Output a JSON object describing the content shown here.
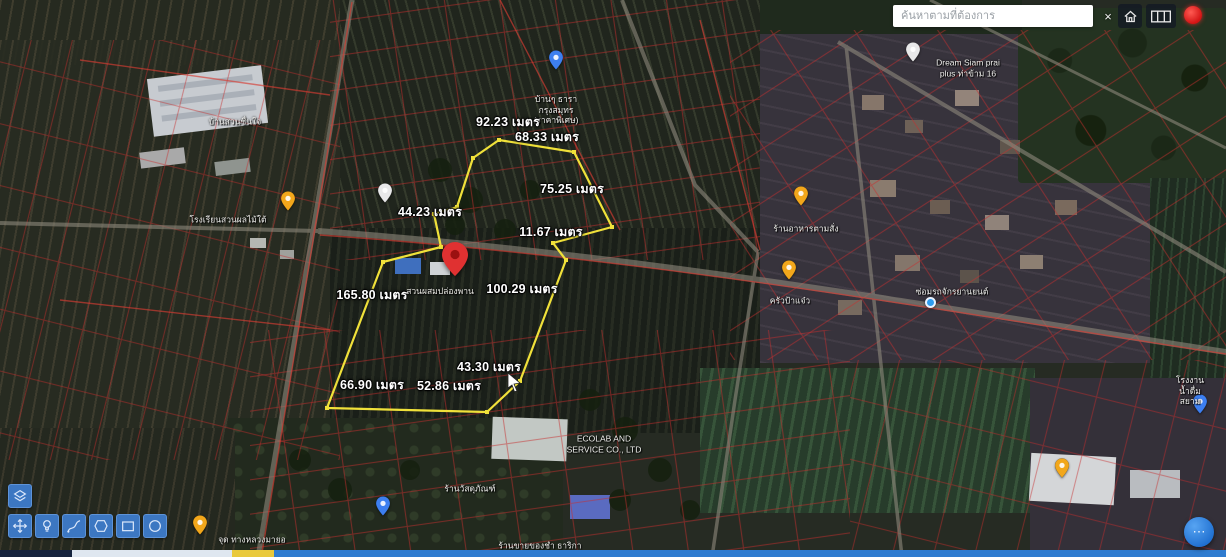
{
  "search": {
    "placeholder": "ค้นหาตามที่ต้องการ"
  },
  "topbar": {
    "close_icon": "×",
    "icons": [
      "close-icon",
      "home-icon",
      "grid-icon",
      "record-dot-icon"
    ]
  },
  "parcel": {
    "color": "#f0e13a",
    "points": [
      [
        499,
        140
      ],
      [
        574,
        152
      ],
      [
        612,
        227
      ],
      [
        553,
        243
      ],
      [
        566,
        260
      ],
      [
        520,
        381
      ],
      [
        487,
        412
      ],
      [
        327,
        408
      ],
      [
        383,
        262
      ],
      [
        441,
        247
      ],
      [
        434,
        214
      ],
      [
        457,
        207
      ],
      [
        473,
        158
      ]
    ]
  },
  "pin": {
    "x": 455,
    "y": 276,
    "label": "สวนผสมปล่องพาน",
    "color": "#e03131"
  },
  "measurements": [
    {
      "text": "92.23 เมตร",
      "x": 508,
      "y": 122
    },
    {
      "text": "68.33 เมตร",
      "x": 547,
      "y": 137
    },
    {
      "text": "75.25 เมตร",
      "x": 572,
      "y": 189
    },
    {
      "text": "44.23 เมตร",
      "x": 430,
      "y": 212
    },
    {
      "text": "11.67 เมตร",
      "x": 551,
      "y": 232
    },
    {
      "text": "100.29 เมตร",
      "x": 522,
      "y": 289
    },
    {
      "text": "165.80 เมตร",
      "x": 372,
      "y": 295
    },
    {
      "text": "43.30 เมตร",
      "x": 489,
      "y": 367
    },
    {
      "text": "66.90 เมตร",
      "x": 372,
      "y": 385
    },
    {
      "text": "52.86 เมตร",
      "x": 449,
      "y": 386
    }
  ],
  "pois": [
    {
      "label": "บ้านสวนชื่นใจ",
      "x": 235,
      "y": 122
    },
    {
      "label": "โรงเรียนสวนผลไม้ใต้",
      "x": 228,
      "y": 220,
      "pin": {
        "color": "yellow",
        "x": 288,
        "y": 211
      }
    },
    {
      "label": "บ้านๆ ธารา\nกรุงสมุทร\n(ราคาพิเศษ)",
      "x": 556,
      "y": 110,
      "pin": {
        "color": "blue",
        "x": 556,
        "y": 70
      }
    },
    {
      "label": "Dream Siam prai\nplus ท่าข้าม 16",
      "x": 968,
      "y": 68,
      "pin": {
        "color": "white",
        "x": 913,
        "y": 62
      }
    },
    {
      "label": "ร้านอาหารตามสั่ง",
      "x": 806,
      "y": 229,
      "pin": {
        "color": "yellow",
        "x": 801,
        "y": 206
      }
    },
    {
      "label": "ครัวป้าแจ๋ว",
      "x": 790,
      "y": 301,
      "pin": {
        "color": "yellow",
        "x": 789,
        "y": 280
      }
    },
    {
      "label": "ซ่อมรถจักรยานยนต์",
      "x": 952,
      "y": 292,
      "pin": {
        "color": "dot",
        "x": 931,
        "y": 303
      }
    },
    {
      "label": "ECOLAB AND\nSERVICE CO., LTD",
      "x": 604,
      "y": 444
    },
    {
      "label": "ร้านวัสดุภัณฑ์",
      "x": 470,
      "y": 489,
      "pin": {
        "color": "blue",
        "x": 383,
        "y": 516
      }
    },
    {
      "label": "โรงงานน้ำดื่ม\nสยาม",
      "x": 1190,
      "y": 391,
      "pin": {
        "color": "blue",
        "x": 1200,
        "y": 414
      }
    },
    {
      "label": "จุด ทางหลวงมายอ",
      "x": 252,
      "y": 540,
      "pin": {
        "color": "yellow",
        "x": 200,
        "y": 535
      }
    },
    {
      "label": "ร้านขายของชำ ธาริกา",
      "x": 540,
      "y": 546
    },
    {
      "label": "",
      "x": 1062,
      "y": 492,
      "pin": {
        "color": "yellow",
        "x": 1062,
        "y": 478
      }
    },
    {
      "label": "",
      "x": 385,
      "y": 215,
      "pin": {
        "color": "white",
        "x": 385,
        "y": 203
      }
    }
  ],
  "toolbar": {
    "buttons": [
      {
        "name": "layers-tool",
        "icon": "layers",
        "x": 8,
        "y": 484
      },
      {
        "name": "move-tool",
        "icon": "move",
        "x": 8,
        "y": 514
      },
      {
        "name": "marker-tool",
        "icon": "bulb",
        "x": 35,
        "y": 514
      },
      {
        "name": "draw-line-tool",
        "icon": "pen",
        "x": 62,
        "y": 514
      },
      {
        "name": "draw-polygon-tool",
        "icon": "polygon",
        "x": 89,
        "y": 514
      },
      {
        "name": "draw-rectangle-tool",
        "icon": "rectangle",
        "x": 116,
        "y": 514
      },
      {
        "name": "draw-circle-tool",
        "icon": "circle",
        "x": 143,
        "y": 514
      }
    ]
  },
  "fab": {
    "glyph": "⋯"
  },
  "colors": {
    "toolbar_blue": "#3c77c2",
    "accent_blue": "#2e86de",
    "parcel_yellow": "#f0e13a",
    "alert_red": "#e8262b",
    "bottombar_blue": "#2f7cd0",
    "cadastre_red": "#c83232"
  }
}
